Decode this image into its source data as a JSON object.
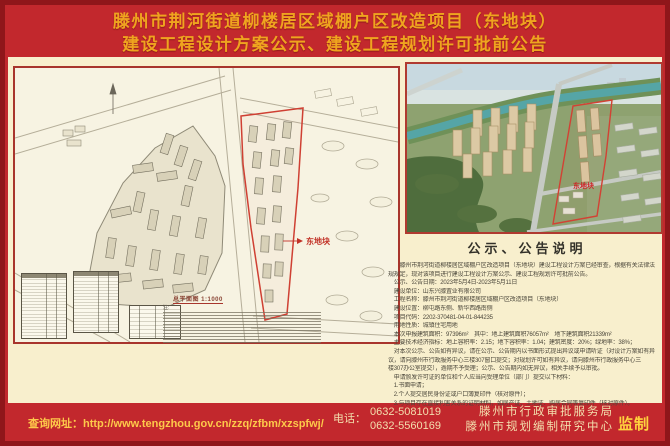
{
  "title": {
    "line1": "滕州市荆河街道柳楼居区域棚户区改造项目（东地块）",
    "line2": "建设工程设计方案公示、建设工程规划许可批前公告"
  },
  "site_plan": {
    "east_block_label": "东地块",
    "caption": "总平面图 1:1000",
    "notes_label": "注:"
  },
  "rendering": {
    "east_block_label": "东地块"
  },
  "notice": {
    "heading": "公示、公告说明",
    "lines": [
      "　　滕州市荆河街道柳楼居区域棚户区改造项目（东地块）建设工程设计方案已经审查，根据有关法律法",
      "规规定，现对该项目进行建设工程设计方案公示、建设工程规划许可批前公告。",
      "　公示、公告日期：2023年5月4日-2023年5月11日",
      "　建设单位：山东兴滕置业有限公司",
      "　工程名称：滕州市荆河街道柳楼居区域棚户区改造项目（东地块）",
      "　建设位置：柳屯路东侧、新华西路南侧",
      "　项目代码：2202-370481-04-01-844235",
      "　用地性质：城镇住宅用地",
      "　本次申报建筑面积：97396m²　其中：地上建筑面积76057m²　地下建筑面积21339m²",
      "　主要技术经济指标：地上容积率：2.15；地下容积率：1.04；建筑密度：20%；绿地率：38%；",
      "　对本次公示、公告如有异议，请在公示、公告期内以书面形式提出异议或申请听证（对设计方案如有异",
      "议，请向滕州市行政服务中心三楼307窗口提交；对规划许可如有异议，请向滕州市行政服务中心三",
      "楼307办公室提交），逾期不予受理；公示、公告期内如无异议，相关手续予以审批。",
      "　申请颁发许可证的单位和个人应当向受理单位（部门）提交以下材料：",
      "　1.书面申请；",
      "　2.个人提交居民身份证或户口簿复印件（核对原件）；",
      "　3.与项目存在直接利害关系的证明材料，如房产证、土地证、购房合同等复印件（核对原件）。"
    ]
  },
  "footer": {
    "url_label": "查询网址：",
    "url": "http://www.tengzhou.gov.cn/zzq/zfbm/xzspfwj/",
    "phone_label": "电话：",
    "phones": [
      "0632-5081019",
      "0632-5560169"
    ],
    "agency1": "滕州市行政审批服务局",
    "agency2": "滕州市规划编制研究中心",
    "supervise": "监制"
  },
  "colors": {
    "poster_red": "#c2282d",
    "border_dark_red": "#8f161a",
    "title_gold": "#efa41f",
    "panel_cream": "#f8efcd",
    "parcel_outline_red": "#cf4033"
  }
}
